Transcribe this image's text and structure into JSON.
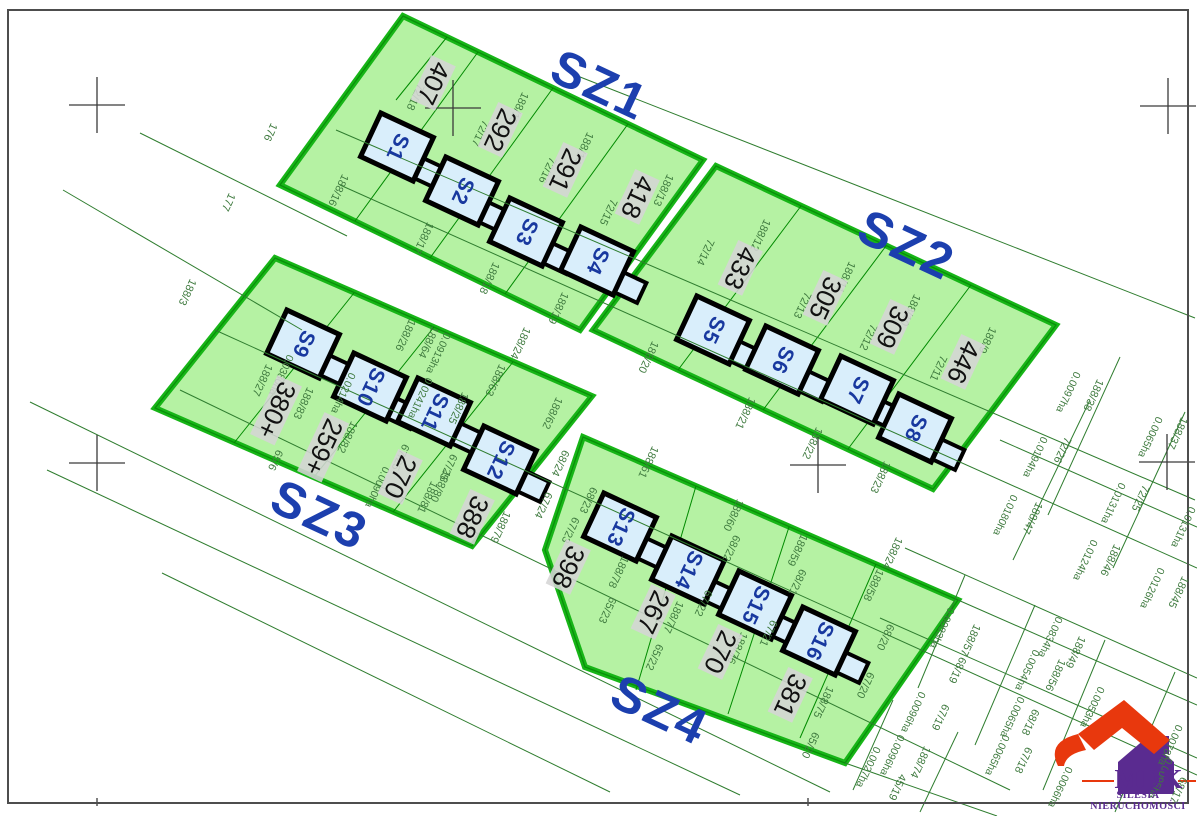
{
  "sections": [
    {
      "id": "sz1",
      "label": "SZ1",
      "x": 600,
      "y": 85
    },
    {
      "id": "sz2",
      "label": "SZ2",
      "x": 907,
      "y": 245
    },
    {
      "id": "sz3",
      "label": "SZ3",
      "x": 320,
      "y": 515
    },
    {
      "id": "sz4",
      "label": "SZ4",
      "x": 660,
      "y": 710
    }
  ],
  "houses": [
    {
      "id": "S1",
      "x": 397,
      "y": 147
    },
    {
      "id": "S2",
      "x": 462,
      "y": 191
    },
    {
      "id": "S3",
      "x": 526,
      "y": 232
    },
    {
      "id": "S4",
      "x": 597,
      "y": 261
    },
    {
      "id": "S5",
      "x": 713,
      "y": 330
    },
    {
      "id": "S6",
      "x": 782,
      "y": 360
    },
    {
      "id": "S7",
      "x": 857,
      "y": 390
    },
    {
      "id": "S8",
      "x": 915,
      "y": 428
    },
    {
      "id": "S9",
      "x": 303,
      "y": 344
    },
    {
      "id": "S10",
      "x": 370,
      "y": 387
    },
    {
      "id": "S11",
      "x": 434,
      "y": 412
    },
    {
      "id": "S12",
      "x": 500,
      "y": 460
    },
    {
      "id": "S13",
      "x": 620,
      "y": 527
    },
    {
      "id": "S14",
      "x": 688,
      "y": 570
    },
    {
      "id": "S15",
      "x": 755,
      "y": 605
    },
    {
      "id": "S16",
      "x": 819,
      "y": 641
    }
  ],
  "plot_numbers": [
    {
      "text": "407",
      "x": 433,
      "y": 83
    },
    {
      "text": "292",
      "x": 500,
      "y": 130
    },
    {
      "text": "291",
      "x": 565,
      "y": 170
    },
    {
      "text": "418",
      "x": 637,
      "y": 197
    },
    {
      "text": "433",
      "x": 740,
      "y": 268
    },
    {
      "text": "305",
      "x": 825,
      "y": 298
    },
    {
      "text": "309",
      "x": 892,
      "y": 327
    },
    {
      "text": "446",
      "x": 963,
      "y": 362
    },
    {
      "text": "380+",
      "x": 276,
      "y": 410
    },
    {
      "text": "259+",
      "x": 323,
      "y": 447
    },
    {
      "text": "270",
      "x": 400,
      "y": 477
    },
    {
      "text": "388",
      "x": 472,
      "y": 517
    },
    {
      "text": "398",
      "x": 568,
      "y": 567
    },
    {
      "text": "267",
      "x": 653,
      "y": 612
    },
    {
      "text": "270",
      "x": 720,
      "y": 652
    },
    {
      "text": "381",
      "x": 790,
      "y": 695
    }
  ],
  "parcel_labels": [
    {
      "text": "188/16",
      "x": 338,
      "y": 190
    },
    {
      "text": "72/18",
      "x": 415,
      "y": 97
    },
    {
      "text": "188/15",
      "x": 518,
      "y": 108
    },
    {
      "text": "72/17",
      "x": 480,
      "y": 133
    },
    {
      "text": "188/14",
      "x": 583,
      "y": 148
    },
    {
      "text": "72/16",
      "x": 547,
      "y": 170
    },
    {
      "text": "188/13",
      "x": 663,
      "y": 190
    },
    {
      "text": "72/15",
      "x": 608,
      "y": 212
    },
    {
      "text": "188/17",
      "x": 423,
      "y": 238
    },
    {
      "text": "188/18",
      "x": 489,
      "y": 278
    },
    {
      "text": "188/19",
      "x": 558,
      "y": 308
    },
    {
      "text": "188/12",
      "x": 760,
      "y": 235
    },
    {
      "text": "72/14",
      "x": 705,
      "y": 252
    },
    {
      "text": "188/11",
      "x": 845,
      "y": 277
    },
    {
      "text": "72/13",
      "x": 802,
      "y": 305
    },
    {
      "text": "188/10",
      "x": 910,
      "y": 310
    },
    {
      "text": "72/12",
      "x": 868,
      "y": 337
    },
    {
      "text": "188/9",
      "x": 987,
      "y": 340
    },
    {
      "text": "72/11",
      "x": 938,
      "y": 368
    },
    {
      "text": "188/20",
      "x": 648,
      "y": 357
    },
    {
      "text": "188/21",
      "x": 745,
      "y": 413
    },
    {
      "text": "188/22",
      "x": 812,
      "y": 443
    },
    {
      "text": "188/23",
      "x": 880,
      "y": 477
    },
    {
      "text": "188/24",
      "x": 520,
      "y": 343
    },
    {
      "text": "188/24",
      "x": 892,
      "y": 553
    },
    {
      "text": "188/27",
      "x": 262,
      "y": 380
    },
    {
      "text": "188/83",
      "x": 303,
      "y": 403
    },
    {
      "text": "188/26",
      "x": 405,
      "y": 335
    },
    {
      "text": "188/64",
      "x": 428,
      "y": 342
    },
    {
      "text": "188/25",
      "x": 458,
      "y": 408
    },
    {
      "text": "188/82",
      "x": 347,
      "y": 437
    },
    {
      "text": "67/25",
      "x": 400,
      "y": 457
    },
    {
      "text": "67/25",
      "x": 448,
      "y": 467
    },
    {
      "text": "188/81",
      "x": 427,
      "y": 497
    },
    {
      "text": "188/80",
      "x": 440,
      "y": 486
    },
    {
      "text": "188/63",
      "x": 495,
      "y": 380
    },
    {
      "text": "188/79",
      "x": 500,
      "y": 527
    },
    {
      "text": "188/62",
      "x": 552,
      "y": 413
    },
    {
      "text": "65/6",
      "x": 275,
      "y": 460
    },
    {
      "text": "68/24",
      "x": 560,
      "y": 463
    },
    {
      "text": "68/23",
      "x": 588,
      "y": 500
    },
    {
      "text": "67/24",
      "x": 543,
      "y": 505
    },
    {
      "text": "67/23",
      "x": 570,
      "y": 530
    },
    {
      "text": "188/61",
      "x": 648,
      "y": 462
    },
    {
      "text": "188/60",
      "x": 733,
      "y": 515
    },
    {
      "text": "188/59",
      "x": 797,
      "y": 550
    },
    {
      "text": "188/58",
      "x": 873,
      "y": 585
    },
    {
      "text": "68/22",
      "x": 731,
      "y": 548
    },
    {
      "text": "68/21",
      "x": 797,
      "y": 582
    },
    {
      "text": "67/22",
      "x": 703,
      "y": 603
    },
    {
      "text": "67/21",
      "x": 768,
      "y": 633
    },
    {
      "text": "188/78",
      "x": 618,
      "y": 572
    },
    {
      "text": "188/77",
      "x": 673,
      "y": 617
    },
    {
      "text": "188/76",
      "x": 737,
      "y": 648
    },
    {
      "text": "188/75",
      "x": 823,
      "y": 702
    },
    {
      "text": "65/23",
      "x": 607,
      "y": 610
    },
    {
      "text": "65/22",
      "x": 654,
      "y": 657
    },
    {
      "text": "65/20",
      "x": 810,
      "y": 745
    },
    {
      "text": "68/20",
      "x": 885,
      "y": 637
    },
    {
      "text": "67/20",
      "x": 865,
      "y": 685
    },
    {
      "text": "188/38",
      "x": 1093,
      "y": 395
    },
    {
      "text": "72/26",
      "x": 1062,
      "y": 450
    },
    {
      "text": "188/37",
      "x": 1177,
      "y": 433
    },
    {
      "text": "72/25",
      "x": 1140,
      "y": 498
    },
    {
      "text": "188/47",
      "x": 1032,
      "y": 518
    },
    {
      "text": "188/46",
      "x": 1110,
      "y": 560
    },
    {
      "text": "188/45",
      "x": 1178,
      "y": 592
    },
    {
      "text": "188/57",
      "x": 970,
      "y": 640
    },
    {
      "text": "188/49",
      "x": 1075,
      "y": 652
    },
    {
      "text": "188/56",
      "x": 1055,
      "y": 675
    },
    {
      "text": "68/19",
      "x": 957,
      "y": 670
    },
    {
      "text": "67/19",
      "x": 940,
      "y": 717
    },
    {
      "text": "68/18",
      "x": 1030,
      "y": 722
    },
    {
      "text": "67/18",
      "x": 1023,
      "y": 760
    },
    {
      "text": "188/74",
      "x": 920,
      "y": 762
    },
    {
      "text": "45/19",
      "x": 897,
      "y": 787
    },
    {
      "text": "68/17",
      "x": 1178,
      "y": 790
    }
  ],
  "boundary_labels": [
    {
      "text": "176",
      "x": 270,
      "y": 132
    },
    {
      "text": "177",
      "x": 228,
      "y": 202
    },
    {
      "text": "188/3",
      "x": 187,
      "y": 292
    }
  ],
  "area_labels": [
    {
      "text": "0.0097ha",
      "x": 1068,
      "y": 392
    },
    {
      "text": "0.0194ha",
      "x": 1035,
      "y": 457
    },
    {
      "text": "0.0065ha",
      "x": 1150,
      "y": 437
    },
    {
      "text": "0.0131ha",
      "x": 1113,
      "y": 503
    },
    {
      "text": "0.0131ha",
      "x": 1183,
      "y": 527
    },
    {
      "text": "0.0180ha",
      "x": 1005,
      "y": 515
    },
    {
      "text": "0.0124ha",
      "x": 1085,
      "y": 560
    },
    {
      "text": "0.0126ha",
      "x": 1152,
      "y": 588
    },
    {
      "text": "0.0834ha",
      "x": 1050,
      "y": 637
    },
    {
      "text": "0.0083ha",
      "x": 942,
      "y": 628
    },
    {
      "text": "0.0054ha",
      "x": 1027,
      "y": 670
    },
    {
      "text": "0.0065ha",
      "x": 1012,
      "y": 717
    },
    {
      "text": "0.0065ha",
      "x": 997,
      "y": 755
    },
    {
      "text": "0.0066ha",
      "x": 1060,
      "y": 787
    },
    {
      "text": "0.0053ha",
      "x": 1092,
      "y": 707
    },
    {
      "text": "0.0078ha",
      "x": 1170,
      "y": 745
    },
    {
      "text": "0.0095ha",
      "x": 1160,
      "y": 778
    },
    {
      "text": "0.0096ha",
      "x": 913,
      "y": 712
    },
    {
      "text": "0.0096ha",
      "x": 892,
      "y": 755
    },
    {
      "text": "0.0027ha",
      "x": 868,
      "y": 767
    },
    {
      "text": "0.0380ha",
      "x": 281,
      "y": 375
    },
    {
      "text": "0.0214ha",
      "x": 343,
      "y": 393
    },
    {
      "text": "0.0913ha",
      "x": 438,
      "y": 353
    },
    {
      "text": "0.0241ha",
      "x": 420,
      "y": 398
    },
    {
      "text": "0.0090ha",
      "x": 377,
      "y": 487
    }
  ],
  "logo": {
    "brand": "MDK",
    "tagline": "SILESIA NIERUCHOMOŚCI"
  },
  "colors": {
    "band_fill": "#b5f2a3",
    "band_border": "#17b517",
    "band_inner_line": "#0a8f0a",
    "line_green": "#2f7d2f",
    "label_green": "#3f7a3f",
    "house_fill": "#d9eefb",
    "house_outline": "#000000",
    "house_label": "#18389f",
    "section_label": "#1c3fae",
    "number_bg": "#d5d5d5",
    "cross": "#3a3a3a",
    "frame": "#4d4d4d",
    "logo_red": "#e8380d",
    "logo_purple": "#5a2b90"
  }
}
